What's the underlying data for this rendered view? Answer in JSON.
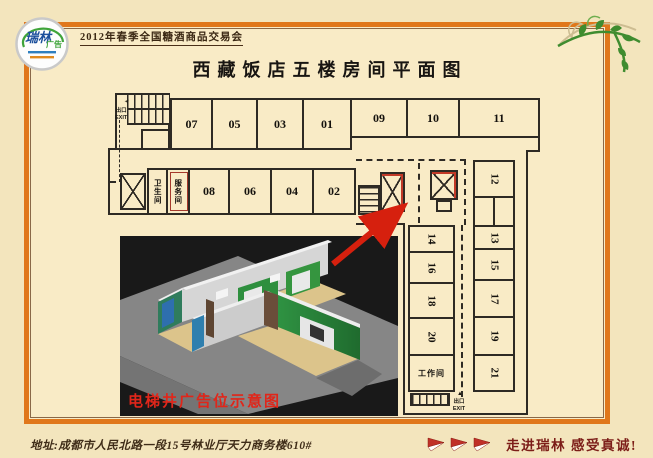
{
  "header": {
    "logo": {
      "brand": "瑞林",
      "sub": "广告"
    },
    "event": "2012年春季全国糖酒商品交易会",
    "title": "西藏饭店五楼房间平面图"
  },
  "plan": {
    "rooms_top_left": [
      "07",
      "05",
      "03",
      "01"
    ],
    "rooms_top_right": [
      "09",
      "10",
      "11"
    ],
    "rooms_mid": [
      "08",
      "06",
      "04",
      "02"
    ],
    "restroom": "卫生间",
    "service_room": "服务间",
    "workroom": "工作间",
    "room_12": "12",
    "wing_left": [
      "14",
      "16",
      "18",
      "20"
    ],
    "wing_right": [
      "13",
      "15",
      "17",
      "19",
      "21"
    ],
    "exit": {
      "cn": "出口",
      "en": "EXIT"
    }
  },
  "inset": {
    "caption": "电梯井广告位示意图"
  },
  "footer": {
    "address": "地址:成都市人民北路一段15号林业厅天力商务楼610#",
    "slogan": "走进瑞林 感受真诚!"
  },
  "colors": {
    "frame": "#e0771b",
    "accent_red": "#c23a28",
    "slogan": "#7c1d18",
    "inset_green": "#2e8f3e"
  }
}
